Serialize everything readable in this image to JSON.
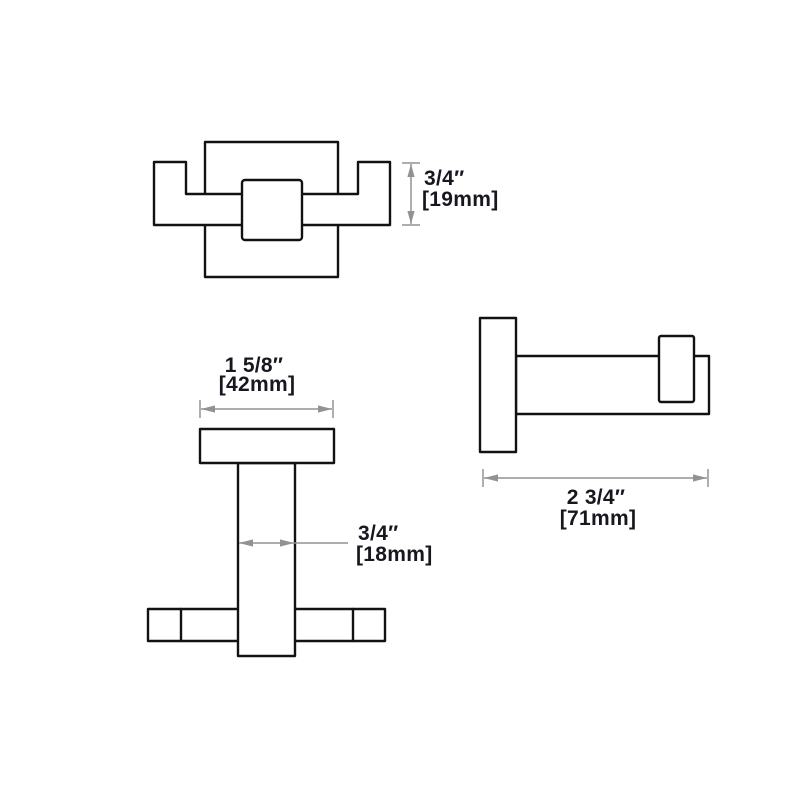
{
  "colors": {
    "background": "#ffffff",
    "outline": "#121212",
    "dimension_gray": "#929292",
    "label_text": "#17171f"
  },
  "views": {
    "top": {
      "depth_dimension": {
        "inches": "3/4″",
        "mm": "[19mm]"
      }
    },
    "front": {
      "width_dimension": {
        "inches": "1 5/8″",
        "mm": "[42mm]"
      },
      "post_dimension": {
        "inches": "3/4″",
        "mm": "[18mm]"
      }
    },
    "side": {
      "projection_dimension": {
        "inches": "2 3/4″",
        "mm": "[71mm]"
      }
    }
  }
}
